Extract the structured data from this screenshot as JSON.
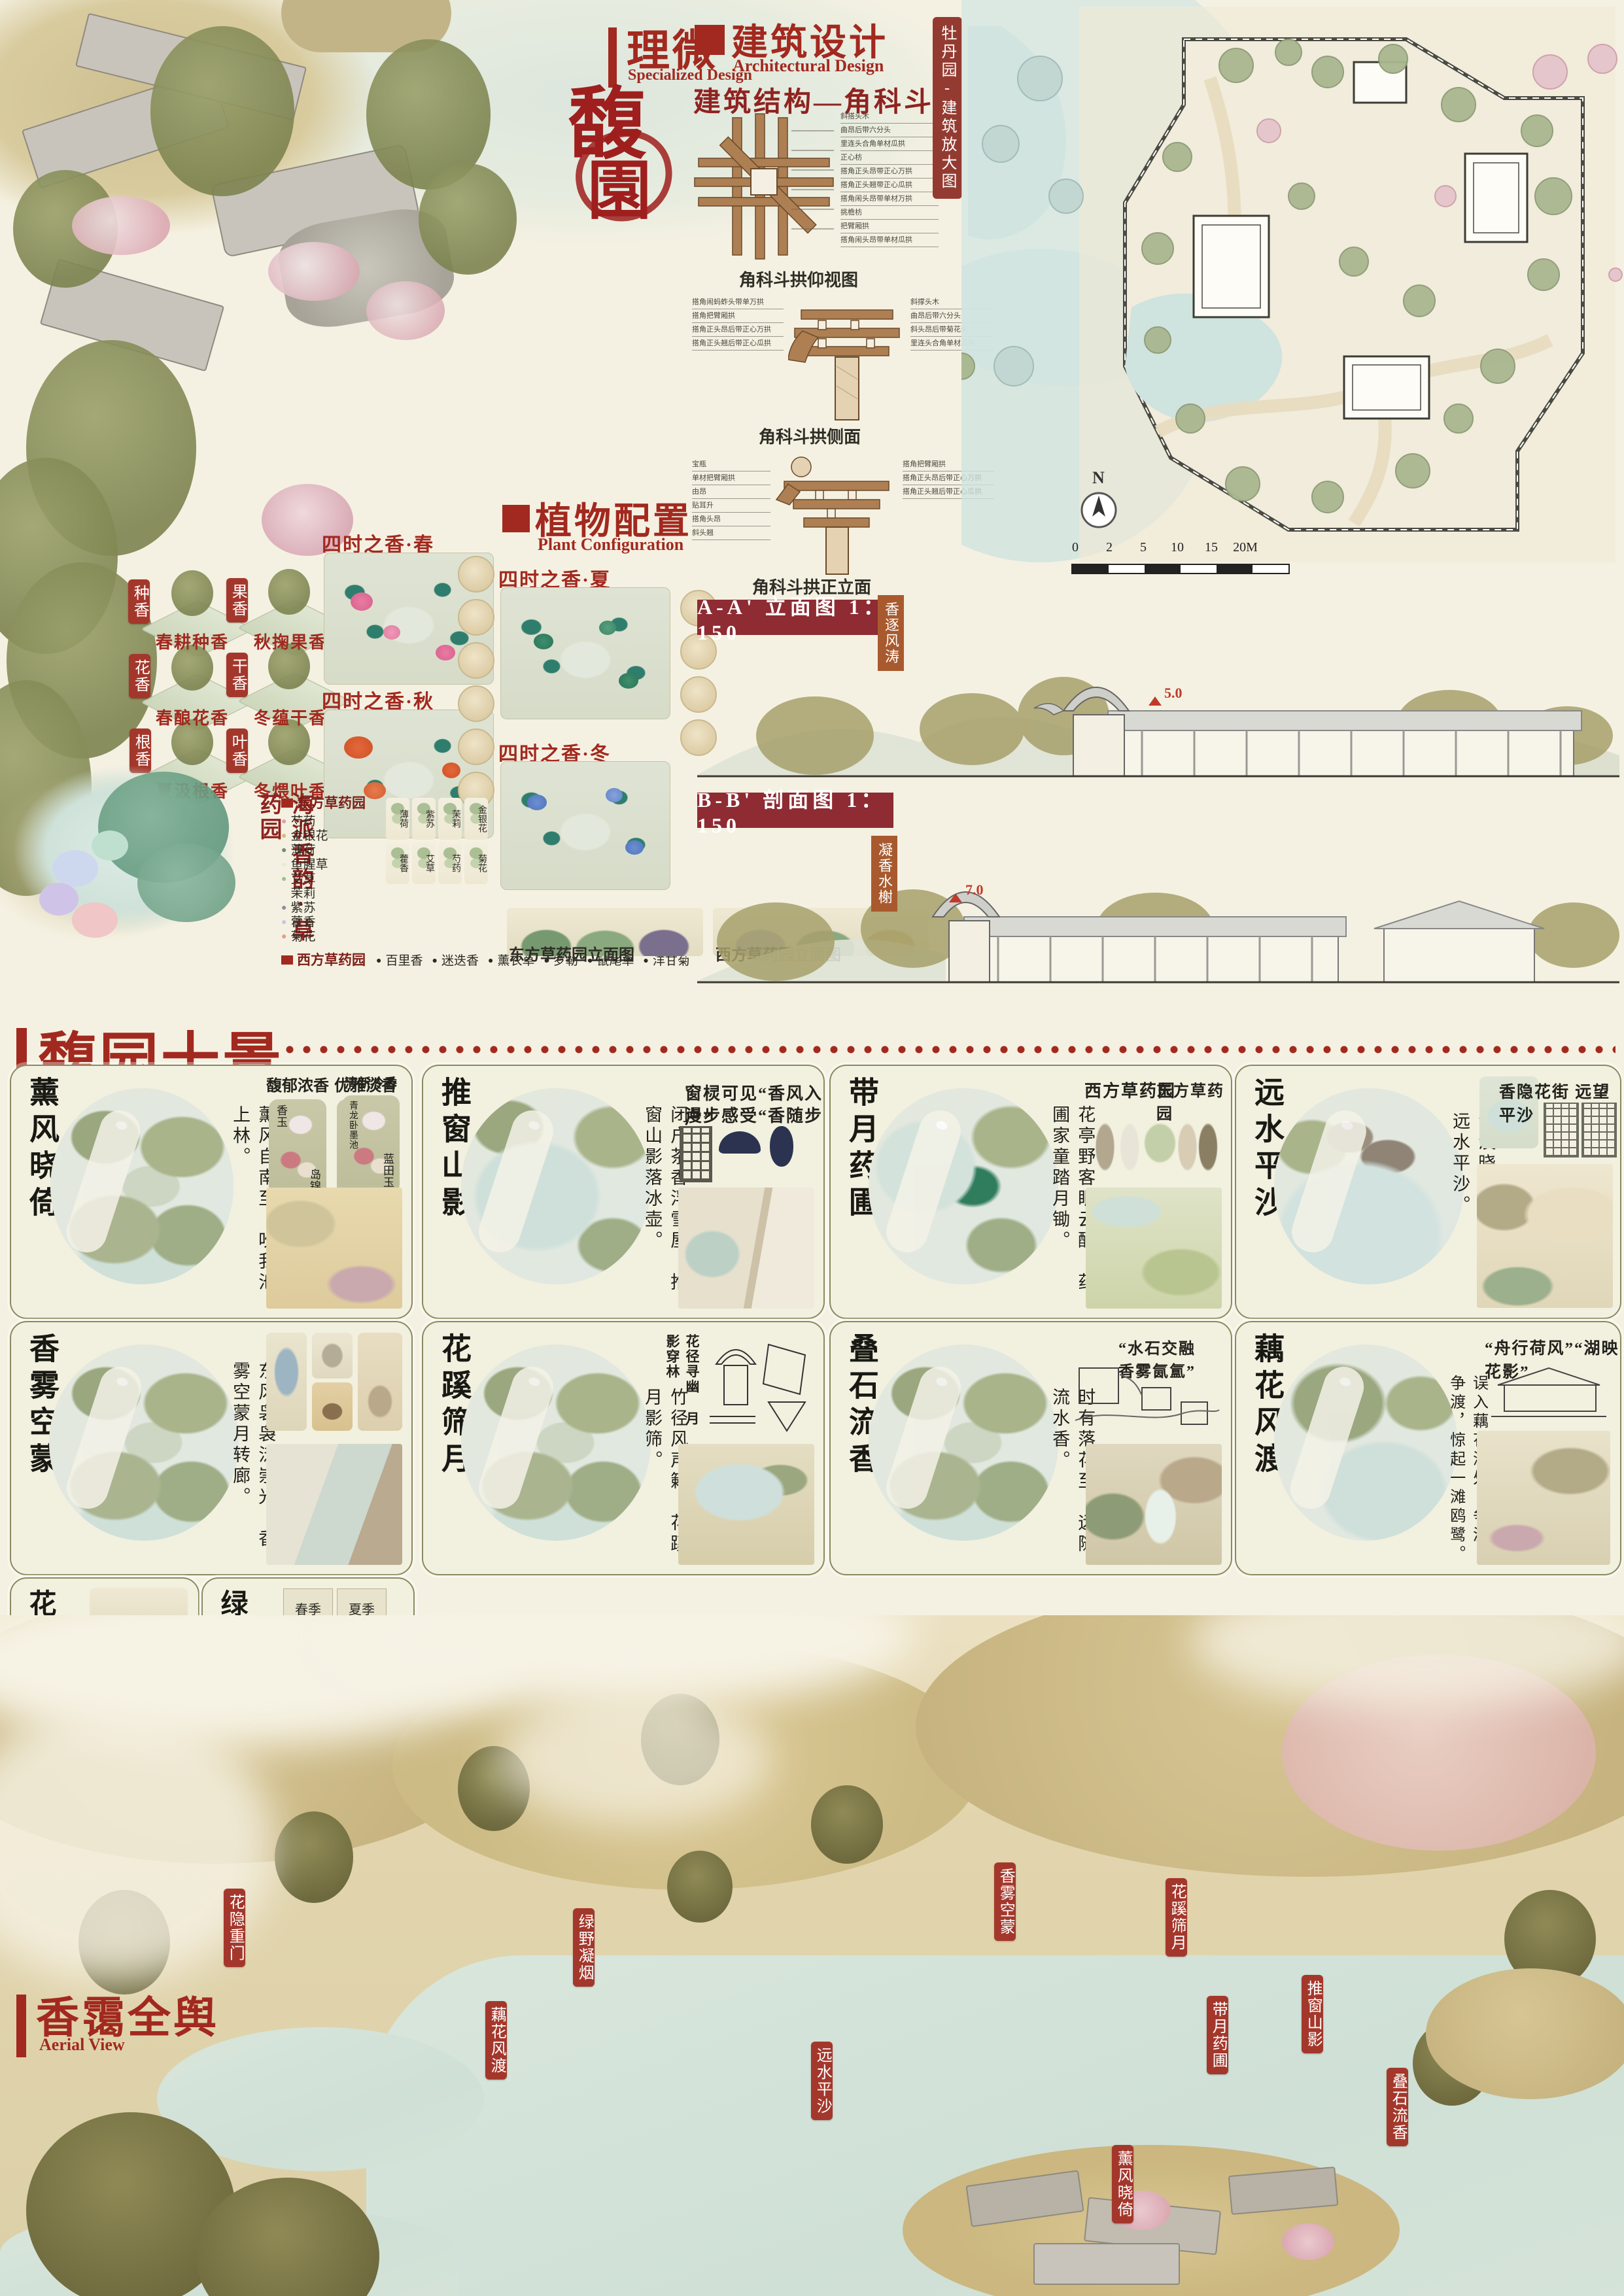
{
  "header": {
    "liwei": {
      "title": "理微",
      "subtitle": "Specialized Design"
    },
    "main_title": {
      "char1": "馥",
      "char2": "園"
    },
    "arch": {
      "title": "建筑设计",
      "subtitle": "Architectural Design",
      "section": "建筑结构—角科斗拱"
    }
  },
  "dougong": {
    "captions": [
      "角科斗拱仰视图",
      "角科斗拱侧面",
      "角科斗拱正立面"
    ],
    "bottom_labels": [
      "斜搭头木",
      "曲昂后带六分头",
      "里连头合角单材瓜拱",
      "正心枋",
      "搭角正头昂带正心万拱",
      "搭角正头翘带正心瓜拱",
      "搭角闹头昂带单材万拱",
      "挑檐枋",
      "把臂厢拱",
      "搭角闹头昂带单材瓜拱"
    ],
    "side_labels_left": [
      "搭角闹蚂蚱头带单万拱",
      "搭角把臂厢拱",
      "搭角正头昂后带正心万拱",
      "搭角正头翘后带正心瓜拱"
    ],
    "side_labels_right": [
      "斜撑头木",
      "曲昂后带六分头",
      "斜头昂后带菊花头",
      "里连头合角单材瓜拱"
    ],
    "front_labels_left": [
      "宝瓶",
      "单材把臂厢拱",
      "由昂",
      "贴耳升",
      "搭角头昂",
      "斜头翘"
    ],
    "front_labels_right": [
      "搭角把臂厢拱",
      "搭角正头昂后带正心万拱",
      "搭角正头翘后带正心瓜拱"
    ]
  },
  "master_plan": {
    "tag": "牡丹园-建筑放大图",
    "north": "N",
    "scale_ticks": [
      "0",
      "2",
      "5",
      "10",
      "15",
      "20M"
    ]
  },
  "plant": {
    "title": "植物配置",
    "subtitle": "Plant Configuration",
    "seasons": [
      "四时之香·春",
      "四时之香·夏",
      "四时之香·秋",
      "四时之香·冬"
    ],
    "fragrance_tags": [
      {
        "tag": "种香",
        "caption": "春耕种香"
      },
      {
        "tag": "果香",
        "caption": "秋掬果香"
      },
      {
        "tag": "花香",
        "caption": "春酿花香"
      },
      {
        "tag": "干香",
        "caption": "冬蕴干香"
      },
      {
        "tag": "根香",
        "caption": "夏汲根香"
      },
      {
        "tag": "叶香",
        "caption": "冬煨叶香"
      }
    ],
    "herb": {
      "vertical_title": "海派香韵·草药园",
      "east_legend": {
        "title": "东方草药园",
        "items": [
          "芍药",
          "金银花",
          "薄荷",
          "鱼腥草",
          "艾草",
          "茉莉",
          "紫苏",
          "藿香",
          "菊花"
        ]
      },
      "west_legend": {
        "title": "西方草药园",
        "items": [
          "百里香",
          "迷迭香",
          "薰衣草",
          "罗勒",
          "鼠尾草",
          "洋甘菊"
        ]
      },
      "thumbs": [
        "薄荷",
        "紫苏",
        "茉莉",
        "金银花",
        "藿香",
        "艾草",
        "芍药",
        "菊花"
      ],
      "east_elev": {
        "caption": "东方草药园立面图",
        "labels": [
          "茉莉",
          "鱼腥草",
          "金银花",
          "紫苏"
        ]
      },
      "west_elev": {
        "caption": "西方草药园立面图",
        "labels": [
          "薰衣草",
          "迷迭香",
          "洋甘菊"
        ]
      }
    }
  },
  "sections_drawings": {
    "aa": {
      "label": "A-A' 立面图 1：150",
      "tag": "香逐风涛",
      "marker": "5.0"
    },
    "bb": {
      "label": "B-B' 剖面图 1：150",
      "tag": "凝香水榭",
      "marker": "7.0"
    }
  },
  "ten_scenes": {
    "title": "馥园十景",
    "subtitle": "Fuyuan Ten Scenes",
    "cards": [
      {
        "title": "薰风晓倚",
        "poem": "薰风自南至，吹我池上林。",
        "grades": [
          {
            "label": "馥郁浓香",
            "flowers": [
              "香玉",
              "岛锦"
            ]
          },
          {
            "label": "优雅淡香",
            "flowers": [
              "姚黄",
              "白玉"
            ]
          },
          {
            "label": "清新冷香",
            "flowers": [
              "青龙卧墨池",
              "蓝田玉"
            ]
          }
        ]
      },
      {
        "title": "推窗山影",
        "poem": "闭户茶香浮雪屋，推窗山影落冰壶。",
        "note": "窗棂可见“香风入户”",
        "note2": "漫步感受“香随步移”"
      },
      {
        "title": "带月药圃",
        "poem": "花亭野客眠云醉，药圃家童踏月锄。",
        "label_left": "西方草药园",
        "label_right": "东方草药园"
      },
      {
        "title": "远水平沙",
        "poem": "淡淡晓山横雾，茫茫远水平沙。",
        "note": "香隐花街 远望平沙"
      },
      {
        "title": "香雾空蒙",
        "poem": "东风袅袅泛崇光，香雾空蒙月转廊。"
      },
      {
        "title": "花蹊筛月",
        "poem": "竹径风声籁，花蹊月影筛。",
        "note": "花径寻幽 月影穿林"
      },
      {
        "title": "叠石流香",
        "poem": "时有落花至，远随流水香。",
        "note": "“水石交融 香雾氤氲”"
      },
      {
        "title": "藕花风渡",
        "poem": "误入藕花深处。争渡，争渡，惊起一滩鸥鹭。",
        "note": "“舟行荷风”“湖映花影”"
      },
      {
        "title": "花隐重门",
        "poem": "堂虚绿野犹开，花隐重门若掩。"
      },
      {
        "title": "绿野凝烟",
        "poem": "堂虚绿野犹开，花隐重门若掩。",
        "seasons": [
          "春季",
          "夏季",
          "秋季",
          "冬季"
        ],
        "season_note": "茶田寻香"
      }
    ]
  },
  "aerial": {
    "title": "香霭全舆",
    "subtitle": "Aerial View",
    "tags": [
      "香雾空蒙",
      "花蹊筛月",
      "花隐重门",
      "绿野凝烟",
      "推窗山影",
      "带月药圃",
      "藕花风渡",
      "远水平沙",
      "叠石流香",
      "薰风晓倚"
    ]
  }
}
